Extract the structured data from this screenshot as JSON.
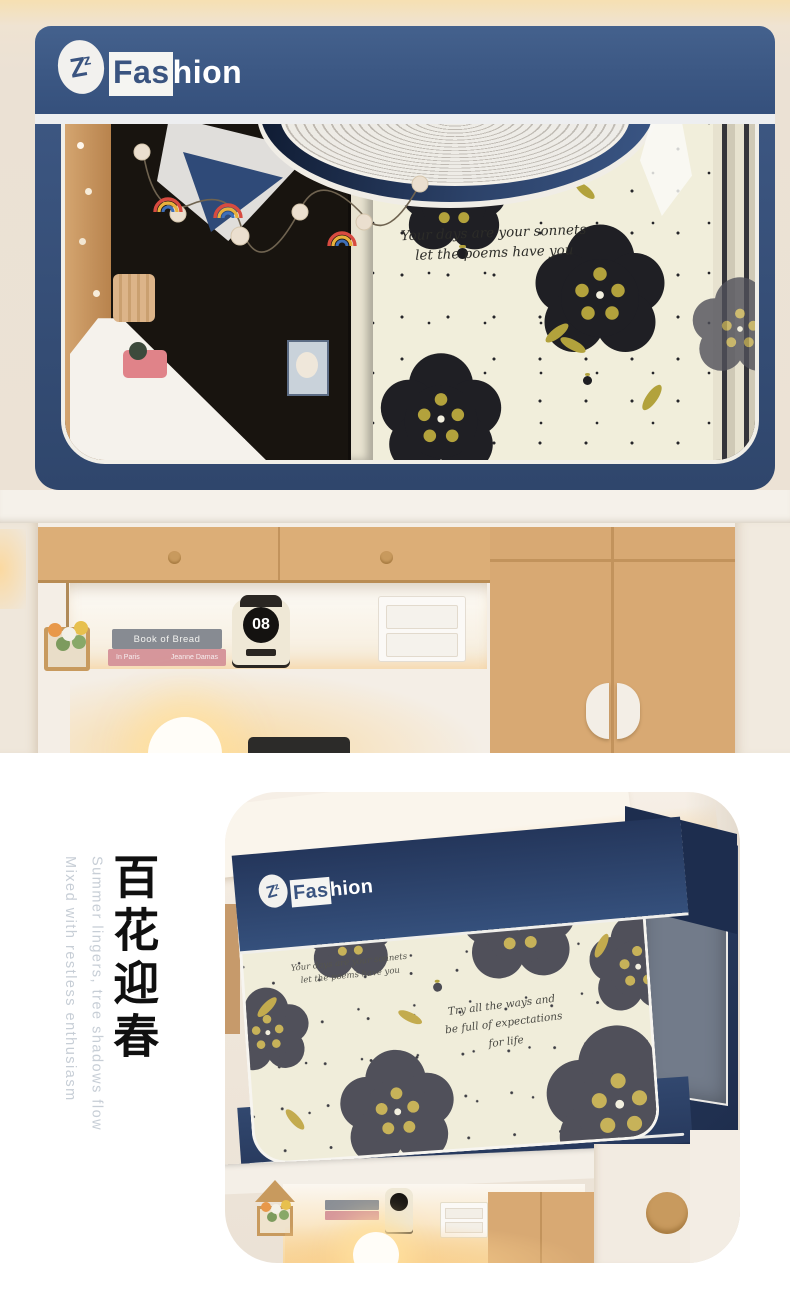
{
  "palette": {
    "navy": "#3b5580",
    "navy_dark": "#22345a",
    "cream_fabric": "#f1eedb",
    "flower_black": "#1f1f24",
    "flower_center": "#b3a23c",
    "flower_gray": "#50505a",
    "flower_center_gray": "#c7b259",
    "badge_orange": "#d15f2a",
    "wood": "#d9aa73"
  },
  "brand": {
    "monogram": "Z",
    "monogram_sup": "z",
    "name_left": "Fas",
    "name_right": "hion"
  },
  "top_photo": {
    "fabric_quote": {
      "line1": "Your days are your sonnets",
      "line2": "let the poems have you"
    },
    "shelf": {
      "book_top_title": "Book of Bread",
      "book_bottom_title": "In Paris",
      "book_bottom_author": "Jeanne Damas",
      "clock_digits": "08"
    }
  },
  "bottom_section": {
    "headline_cn": "百花迎春",
    "tagline_en_line1": "Summer lingers, tree shadows flow",
    "tagline_en_line2": "Mixed with restless enthusiasm",
    "photo": {
      "fabric_quote": {
        "line1": "Your days are your sonnets",
        "line2": "let the poems have you"
      },
      "fabric_quote2": {
        "line1": "Try all the ways and",
        "line2": "be full of expectations",
        "line3": "for life"
      },
      "badge": {
        "line1": "Happy",
        "line2": "Life"
      }
    }
  }
}
